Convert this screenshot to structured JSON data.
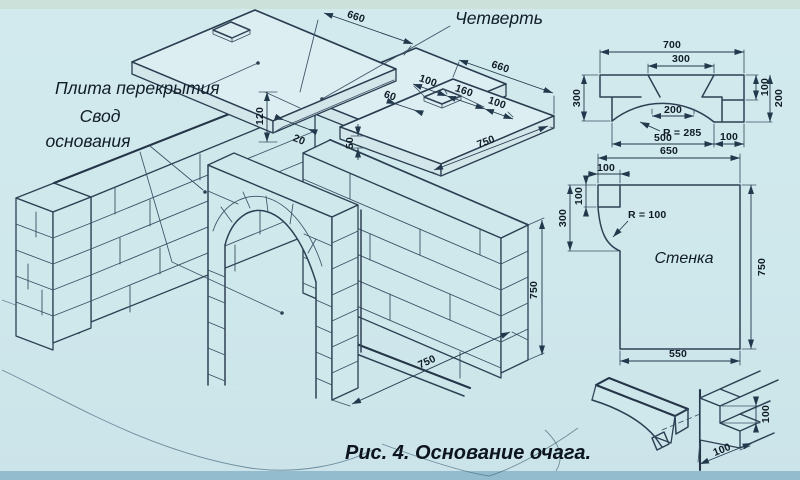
{
  "labels": {
    "plita": "Плита перекрытия",
    "svod1": "Свод",
    "svod2": "основания",
    "chetvert": "Четверть",
    "stenka": "Стенка",
    "caption": "Рис. 4. Основание очага."
  },
  "iso": {
    "slab_width_left": "660",
    "slab_width_small": "660",
    "hole_width": "100",
    "hole_gap": "160",
    "hole_edge": "100",
    "hole_depth": "60",
    "slab_thickness": "50",
    "rebate": "20",
    "gap": "120",
    "slab_depth_small": "750",
    "wall_height": "750",
    "opening_width": "750"
  },
  "vault": {
    "top_width": "700",
    "opening_top": "300",
    "left_height": "300",
    "arch_top_width": "200",
    "radius": "R = 285",
    "bottom_left": "500",
    "bottom_right": "100",
    "right_upper": "100",
    "right_total": "200"
  },
  "wall": {
    "top_width": "650",
    "tab_width": "100",
    "tab_height": "100",
    "left_height": "300",
    "radius": "R = 100",
    "right_height": "750",
    "bottom_width": "550"
  },
  "joint": {
    "step_height": "100",
    "step_width": "100"
  }
}
